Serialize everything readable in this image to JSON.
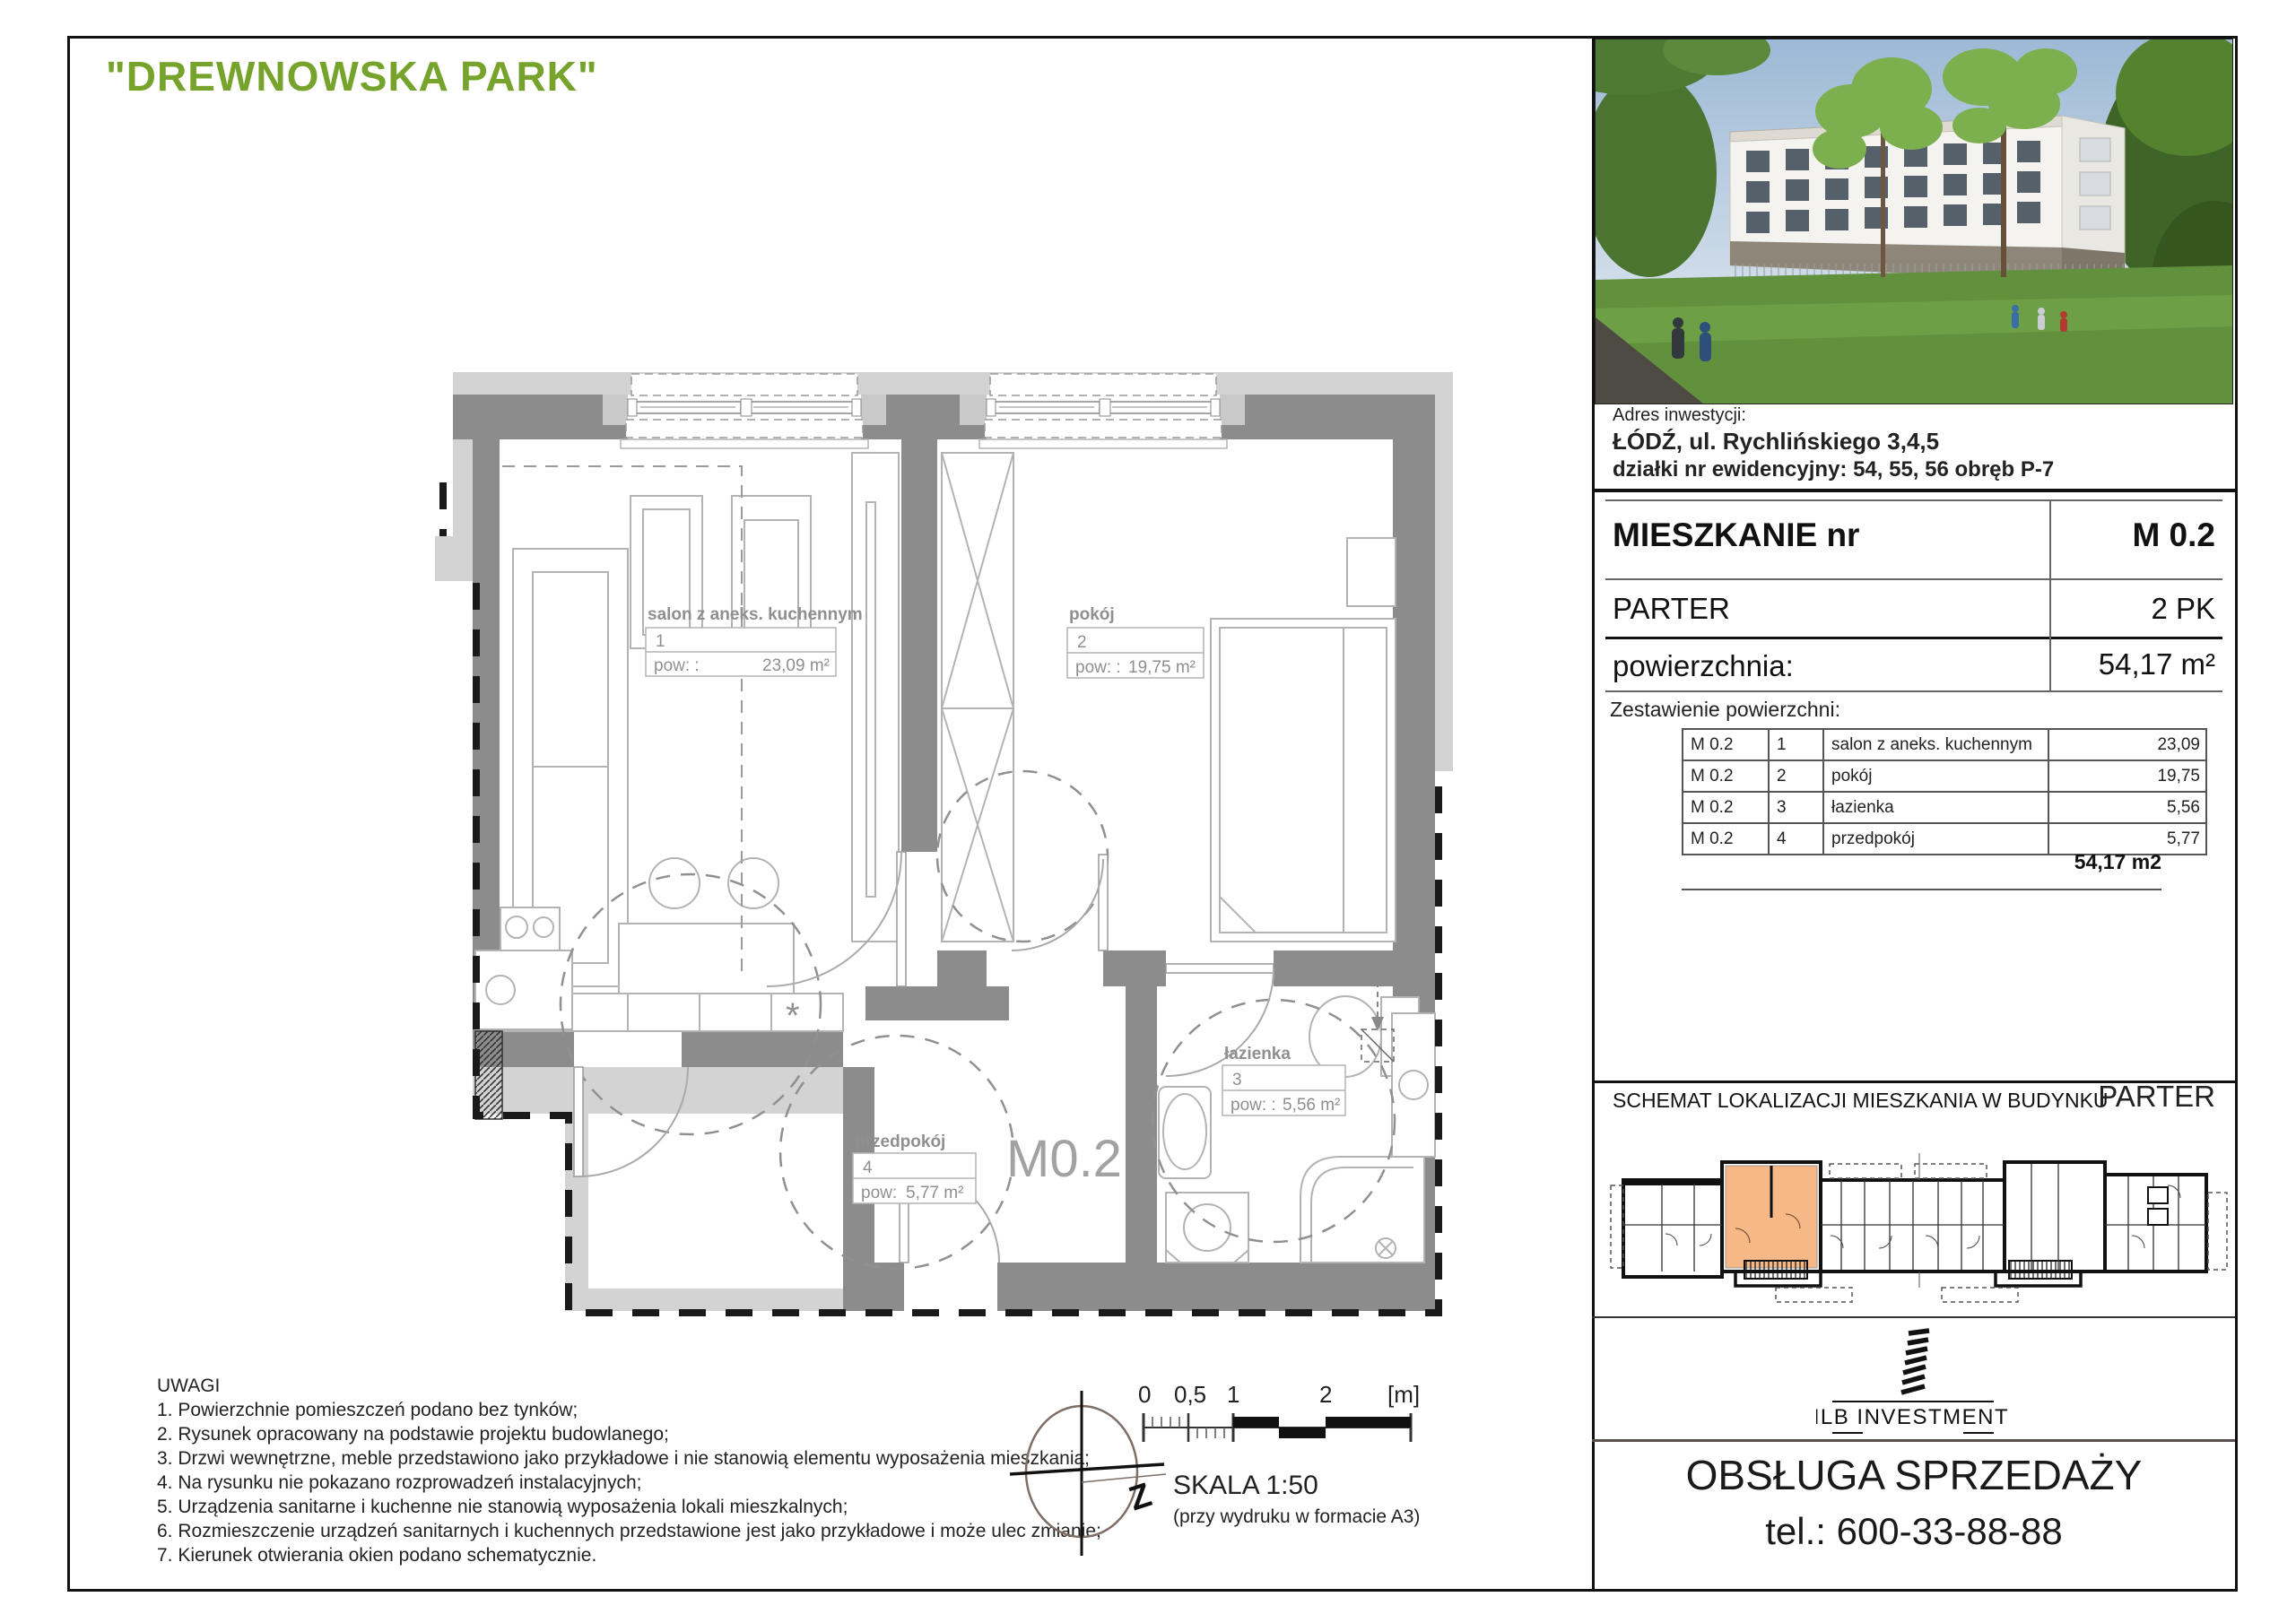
{
  "title": "\"DREWNOWSKA PARK\"",
  "plan": {
    "apartment_label": "M0.2",
    "star_symbol": "*",
    "rooms": [
      {
        "name": "salon z aneks. kuchennym",
        "num": "1",
        "pow_label": "pow: :",
        "area": "23,09 m²"
      },
      {
        "name": "pokój",
        "num": "2",
        "pow_label": "pow: :",
        "area": "19,75 m²"
      },
      {
        "name": "łazienka",
        "num": "3",
        "pow_label": "pow: :",
        "area": "5,56 m²"
      },
      {
        "name": "przedpokój",
        "num": "4",
        "pow_label": "pow:",
        "area": "5,77 m²"
      }
    ]
  },
  "notes": {
    "heading": "UWAGI",
    "items": [
      "1. Powierzchnie pomieszczeń podano bez tynków;",
      "2. Rysunek opracowany na podstawie projektu budowlanego;",
      "3. Drzwi wewnętrzne, meble przedstawiono jako przykładowe i nie stanowią elementu wyposażenia mieszkania;",
      "4. Na rysunku nie pokazano rozprowadzeń instalacyjnych;",
      "5. Urządzenia sanitarne i kuchenne nie stanowią wyposażenia lokali mieszkalnych;",
      "6. Rozmieszczenie urządzeń sanitarnych i kuchennych przedstawione jest jako przykładowe i może ulec zmianie;",
      "7. Kierunek otwierania okien podano schematycznie."
    ]
  },
  "compass": {
    "label": "Z"
  },
  "scale": {
    "ticks": [
      "0",
      "0,5",
      "1",
      "2",
      "[m]"
    ],
    "label": "SKALA 1:50",
    "sublabel": "(przy wydruku w formacie A3)"
  },
  "sidebar": {
    "address": {
      "heading": "Adres inwestycji:",
      "line1": "ŁÓDŹ, ul. Rychlińskiego 3,4,5",
      "line2": "działki nr ewidencyjny: 54, 55, 56 obręb P-7"
    },
    "apartment": {
      "label": "MIESZKANIE nr",
      "number": "M 0.2",
      "floor": "PARTER",
      "rooms": "2 PK",
      "area_label": "powierzchnia:",
      "area": "54,17 m²"
    },
    "area_table": {
      "heading": "Zestawienie powierzchni:",
      "rows": [
        [
          "M 0.2",
          "1",
          "salon z aneks. kuchennym",
          "23,09"
        ],
        [
          "M 0.2",
          "2",
          "pokój",
          "19,75"
        ],
        [
          "M 0.2",
          "3",
          "łazienka",
          "5,56"
        ],
        [
          "M 0.2",
          "4",
          "przedpokój",
          "5,77"
        ]
      ],
      "total": "54,17 m2"
    },
    "schematic": {
      "title": "SCHEMAT LOKALIZACJI MIESZKANIA W BUDYNKU",
      "floor": "PARTER"
    },
    "brand": {
      "name": "MLB INVESTMENTS"
    },
    "sales": {
      "line1": "OBSŁUGA SPRZEDAŻY",
      "line2": "tel.: 600-33-88-88"
    }
  },
  "colors": {
    "accent_green": "#76a32b",
    "unit_highlight": "#f5b886",
    "wall_gray": "#8c8c8c",
    "wall_light": "#d3d3d3"
  }
}
